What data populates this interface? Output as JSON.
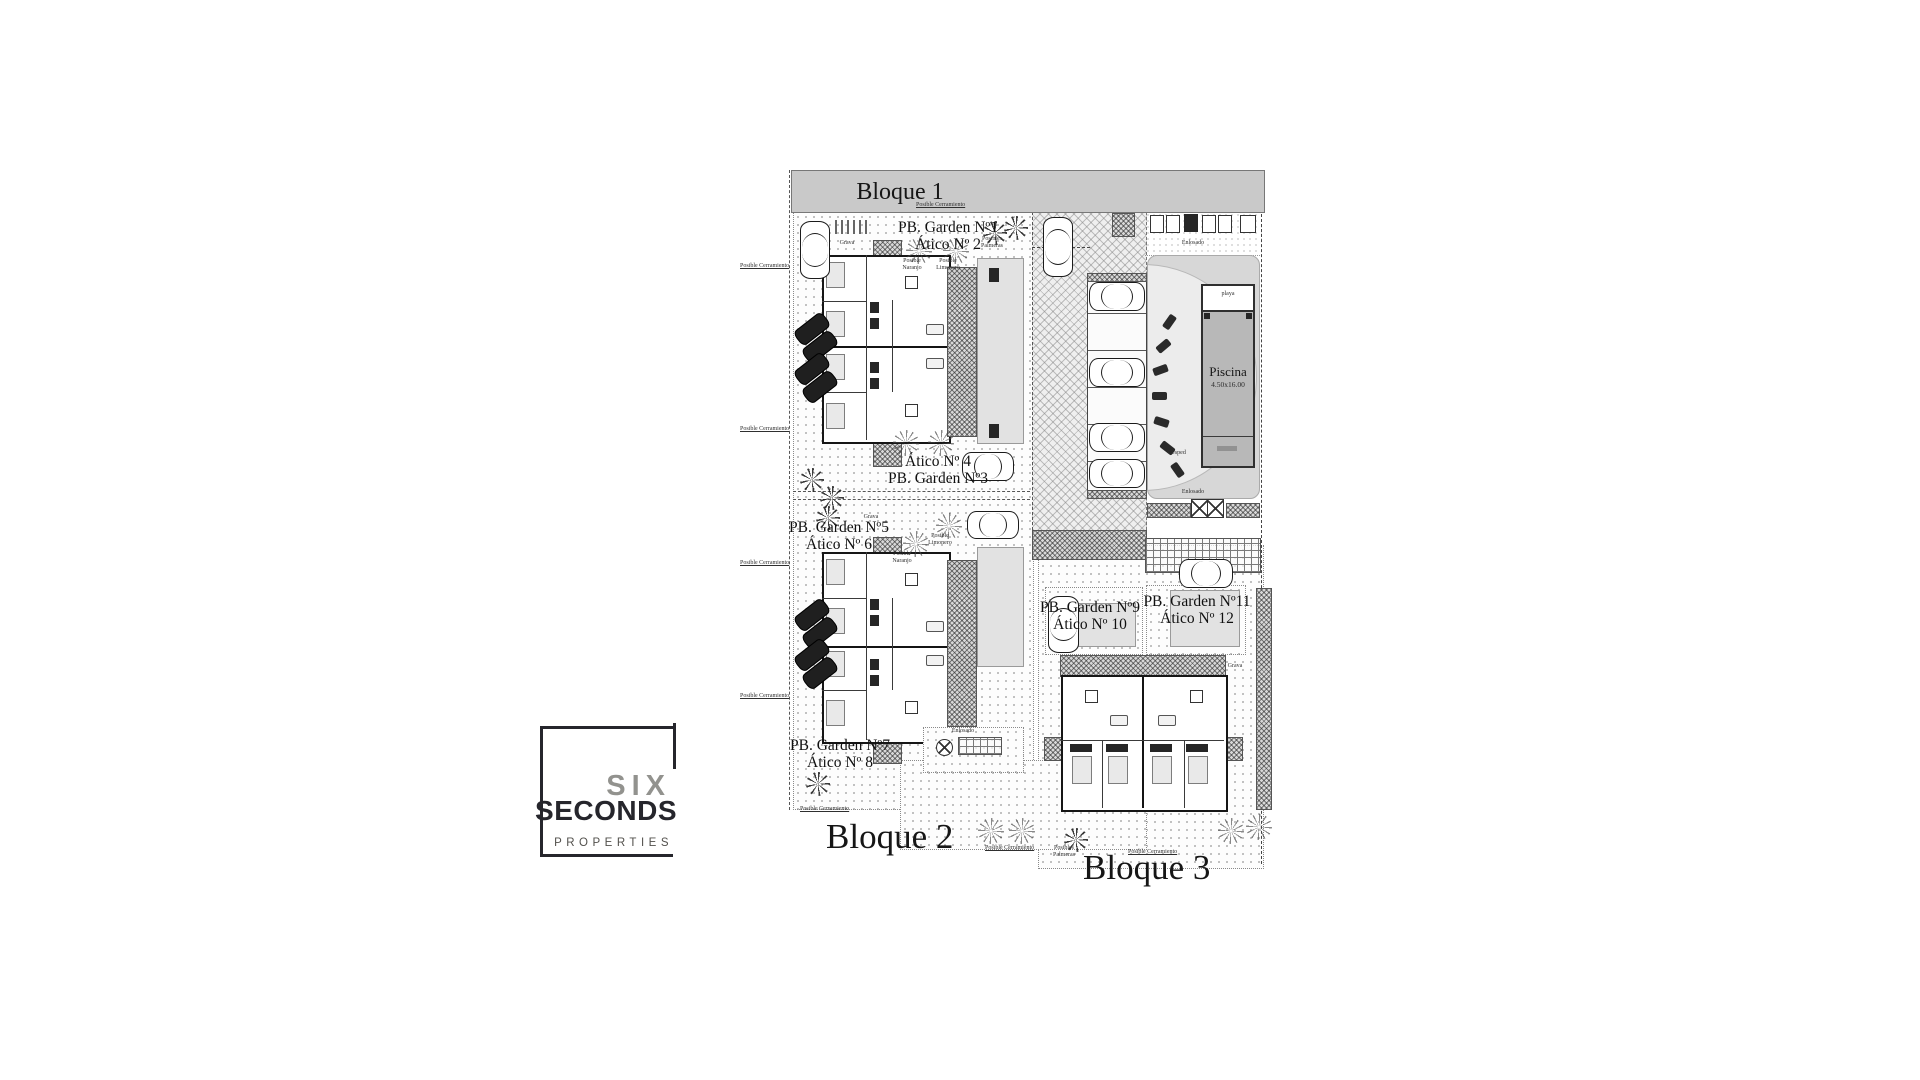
{
  "page": {
    "background": "#ffffff"
  },
  "logo": {
    "word1": "SIX",
    "word2": "SECONDS",
    "word3": "PROPERTIES",
    "frame_color": "#26262c",
    "word1_color": "#92928e",
    "word2_color": "#26262c",
    "word3_color": "#52504c"
  },
  "plan": {
    "banner_label": "Bloque 1",
    "bloque2_label": "Bloque 2",
    "bloque3_label": "Bloque 3",
    "units": [
      {
        "line1": "PB. Garden Nº1",
        "line2": "Ático Nº 2"
      },
      {
        "line1": "Ático Nº 4",
        "line2": "PB. Garden Nº3"
      },
      {
        "line1": "PB. Garden Nº5",
        "line2": "Ático Nº 6"
      },
      {
        "line1": "PB. Garden Nº7",
        "line2": "Ático Nº 8"
      },
      {
        "line1": "PB. Garden Nº9",
        "line2": "Ático Nº 10"
      },
      {
        "line1": "PB. Garden Nº11",
        "line2": "Ático Nº 12"
      }
    ],
    "pool": {
      "name": "Piscina",
      "size": "4.50x16.00"
    },
    "annotations": [
      {
        "text": "Posible Cerramiento"
      },
      {
        "text": "Posible Naranjo"
      },
      {
        "text": "Posible Limonero"
      },
      {
        "text": "Posibles Palmeras"
      },
      {
        "text": "Grava"
      },
      {
        "text": "Cesped"
      },
      {
        "text": "Enlosado"
      },
      {
        "text": "playa"
      }
    ]
  }
}
